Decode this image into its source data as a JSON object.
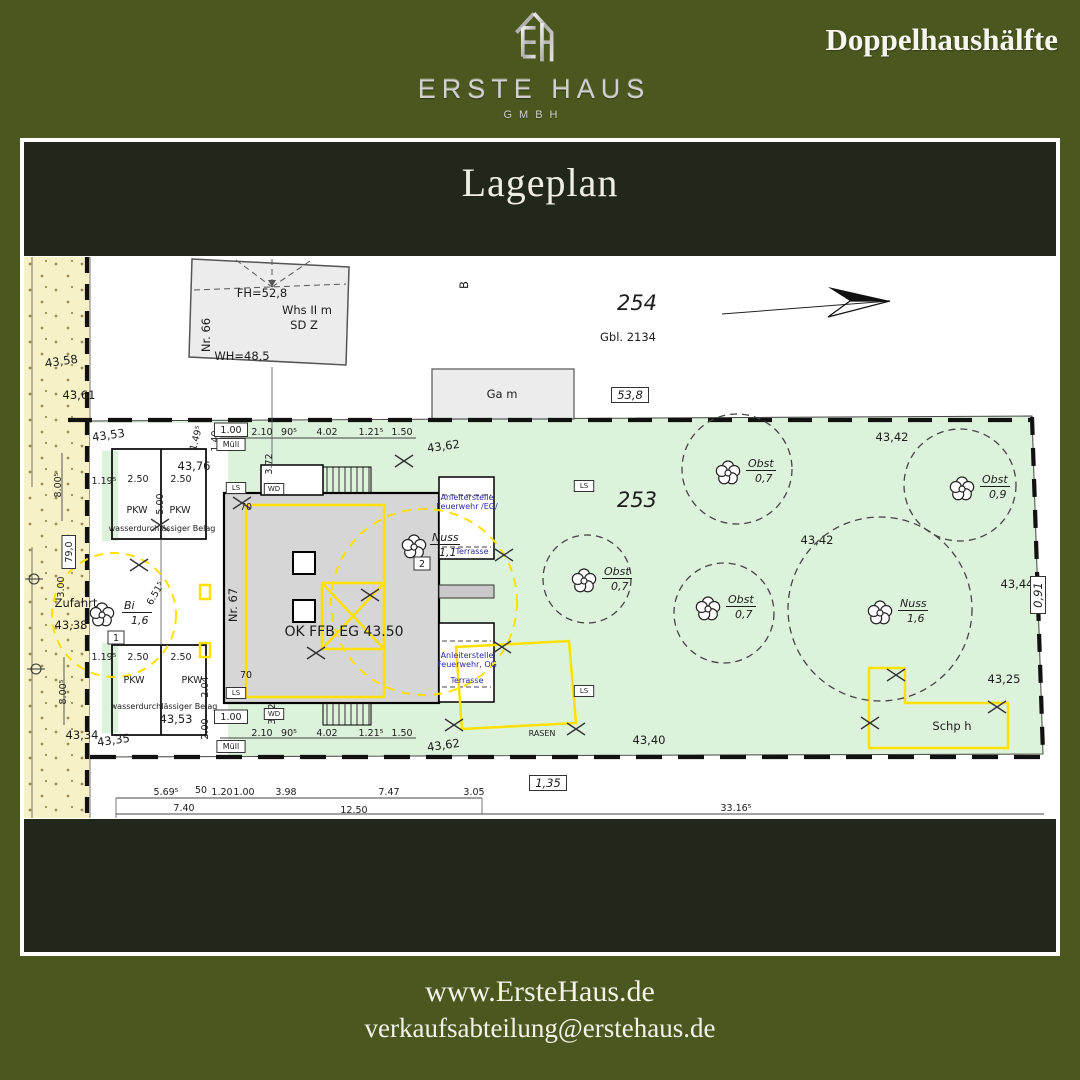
{
  "header": {
    "brand": "ERSTE HAUS",
    "brand_sub": "GMBH",
    "tagline": "Doppelhaushälfte"
  },
  "card": {
    "title": "Lageplan"
  },
  "footer": {
    "website": "www.ErsteHaus.de",
    "email": "verkaufsabteilung@erstehaus.de"
  },
  "colors": {
    "page_bg": "#4a581f",
    "band_bg": "#22271c",
    "card_bg": "#ffffff",
    "parcel_green": "#ddf2db",
    "street_yellow": "#f6f1c6",
    "accent_yellow": "#ffe000",
    "note_blue": "#2b2b9e",
    "building_gray": "#d6d6d6",
    "neighbor_gray": "#ececec",
    "text_light": "#f3f2e9",
    "logo_silver": "#d0d0d0"
  },
  "plan": {
    "parcels": [
      {
        "number": "254",
        "register": "Gbl. 2134"
      },
      {
        "number": "253"
      }
    ],
    "labels": [
      {
        "t": "FH=52,8",
        "x": 238,
        "y": 40,
        "n": "ridge-height-label"
      },
      {
        "t": "Nr. 66",
        "x": 186,
        "y": 78,
        "r": -90,
        "n": "house-number-66"
      },
      {
        "t": "Whs II m",
        "x": 283,
        "y": 57
      },
      {
        "t": "SD Z",
        "x": 280,
        "y": 72
      },
      {
        "t": "WH=48,5",
        "x": 218,
        "y": 103
      },
      {
        "t": "B",
        "x": 444,
        "y": 28,
        "r": -90
      },
      {
        "t": "254",
        "x": 613,
        "y": 53,
        "s": "lg",
        "n": "parcel-number-254"
      },
      {
        "t": "Gbl. 2134",
        "x": 604,
        "y": 84
      },
      {
        "t": "Ga m",
        "x": 478,
        "y": 141,
        "n": "garage-label"
      },
      {
        "t": "53,8",
        "x": 606,
        "y": 142,
        "s": "it",
        "box": true
      },
      {
        "t": "43,58",
        "x": 38,
        "y": 108,
        "r": -8
      },
      {
        "t": "43,61",
        "x": 55,
        "y": 142
      },
      {
        "t": "43,53",
        "x": 85,
        "y": 182,
        "r": -8
      },
      {
        "t": "Zufahrt",
        "x": 52,
        "y": 350,
        "n": "driveway-label"
      },
      {
        "t": "43,38",
        "x": 47,
        "y": 372
      },
      {
        "t": "43,34",
        "x": 58,
        "y": 482
      },
      {
        "t": "79,0",
        "x": 48,
        "y": 295,
        "r": -90,
        "s": "sm",
        "box": true
      },
      {
        "t": "3.00",
        "x": 40,
        "y": 330,
        "r": -90,
        "s": "sm"
      },
      {
        "t": "8.00⁵",
        "x": 37,
        "y": 228,
        "r": -90,
        "s": "sm"
      },
      {
        "t": "8.00⁵",
        "x": 42,
        "y": 435,
        "r": -90,
        "s": "sm"
      },
      {
        "t": "43,76",
        "x": 170,
        "y": 213
      },
      {
        "t": "2.50",
        "x": 114,
        "y": 225,
        "s": "sm"
      },
      {
        "t": "2.50",
        "x": 157,
        "y": 225,
        "s": "sm"
      },
      {
        "t": "1.19⁵",
        "x": 80,
        "y": 227,
        "s": "sm"
      },
      {
        "t": "5.00",
        "x": 139,
        "y": 247,
        "r": -90,
        "s": "sm"
      },
      {
        "t": "PKW",
        "x": 113,
        "y": 256,
        "s": "sm",
        "n": "parking-space-label"
      },
      {
        "t": "PKW",
        "x": 156,
        "y": 256,
        "s": "sm",
        "n": "parking-space-label"
      },
      {
        "t": "wasserdurchlässiger Belag",
        "x": 138,
        "y": 274,
        "s": "xs"
      },
      {
        "t": "1.19⁵",
        "x": 80,
        "y": 403,
        "s": "sm"
      },
      {
        "t": "2.50",
        "x": 114,
        "y": 403,
        "s": "sm"
      },
      {
        "t": "2.50",
        "x": 157,
        "y": 403,
        "s": "sm"
      },
      {
        "t": "PKW",
        "x": 110,
        "y": 426,
        "s": "sm",
        "n": "parking-space-label"
      },
      {
        "t": "PKW",
        "x": 168,
        "y": 426,
        "s": "sm",
        "n": "parking-space-label"
      },
      {
        "t": "wasserdurchlässiger Belag",
        "x": 140,
        "y": 452,
        "s": "xs"
      },
      {
        "t": "43,53",
        "x": 152,
        "y": 466
      },
      {
        "t": "43,35",
        "x": 90,
        "y": 487,
        "r": -8
      },
      {
        "t": "1.49⁵",
        "x": 175,
        "y": 182,
        "r": -75,
        "s": "sm"
      },
      {
        "t": "1.40",
        "x": 194,
        "y": 184,
        "r": -90,
        "s": "sm"
      },
      {
        "t": "1.00",
        "x": 207,
        "y": 176,
        "s": "sm",
        "box": true
      },
      {
        "t": "Müll",
        "x": 207,
        "y": 190,
        "s": "xs",
        "box": true
      },
      {
        "t": "2.10",
        "x": 238,
        "y": 178,
        "s": "sm"
      },
      {
        "t": "90⁵",
        "x": 265,
        "y": 178,
        "s": "sm"
      },
      {
        "t": "4.02",
        "x": 303,
        "y": 178,
        "s": "sm"
      },
      {
        "t": "1.21⁵",
        "x": 347,
        "y": 178,
        "s": "sm"
      },
      {
        "t": "1.50",
        "x": 378,
        "y": 178,
        "s": "sm"
      },
      {
        "t": "43,62",
        "x": 420,
        "y": 193,
        "r": -8
      },
      {
        "t": "3.72",
        "x": 248,
        "y": 207,
        "r": -90,
        "s": "sm"
      },
      {
        "t": "70",
        "x": 222,
        "y": 253,
        "s": "sm"
      },
      {
        "t": "Nr. 67",
        "x": 213,
        "y": 348,
        "r": -90,
        "n": "house-number-67"
      },
      {
        "t": "6.51⁵",
        "x": 134,
        "y": 338,
        "r": -60,
        "s": "sm"
      },
      {
        "t": "OK FFB EG 43.50",
        "x": 320,
        "y": 379,
        "s": "md2",
        "n": "floor-level-label"
      },
      {
        "t": "70",
        "x": 222,
        "y": 421,
        "s": "sm"
      },
      {
        "t": "2.04",
        "x": 184,
        "y": 430,
        "r": -90,
        "s": "sm"
      },
      {
        "t": "2.00",
        "x": 184,
        "y": 472,
        "r": -90,
        "s": "sm"
      },
      {
        "t": "1.00",
        "x": 207,
        "y": 463,
        "s": "sm",
        "box": true
      },
      {
        "t": "Müll",
        "x": 207,
        "y": 492,
        "s": "xs",
        "box": true
      },
      {
        "t": "2.10",
        "x": 238,
        "y": 479,
        "s": "sm"
      },
      {
        "t": "90⁵",
        "x": 265,
        "y": 479,
        "s": "sm"
      },
      {
        "t": "4.02",
        "x": 303,
        "y": 479,
        "s": "sm"
      },
      {
        "t": "1.21⁵",
        "x": 347,
        "y": 479,
        "s": "sm"
      },
      {
        "t": "1.50",
        "x": 378,
        "y": 479,
        "s": "sm"
      },
      {
        "t": "43,62",
        "x": 420,
        "y": 492,
        "r": -8
      },
      {
        "t": "3.72",
        "x": 251,
        "y": 457,
        "r": -90,
        "s": "sm"
      },
      {
        "t": "LS",
        "x": 212,
        "y": 233,
        "s": "ls",
        "box": true
      },
      {
        "t": "WD",
        "x": 250,
        "y": 234,
        "s": "ls",
        "box": true
      },
      {
        "t": "LS",
        "x": 560,
        "y": 231,
        "s": "ls",
        "box": true
      },
      {
        "t": "LS",
        "x": 212,
        "y": 438,
        "s": "ls",
        "box": true
      },
      {
        "t": "WD",
        "x": 250,
        "y": 459,
        "s": "ls",
        "box": true
      },
      {
        "t": "LS",
        "x": 560,
        "y": 436,
        "s": "ls",
        "box": true
      },
      {
        "t": "Anleiterstelle",
        "x": 443,
        "y": 243,
        "s": "xsb"
      },
      {
        "t": "Feuerwehr /EG/",
        "x": 443,
        "y": 252,
        "s": "xsb"
      },
      {
        "t": "Terrasse",
        "x": 448,
        "y": 297,
        "s": "xsb"
      },
      {
        "t": "Anleiterstelle",
        "x": 443,
        "y": 401,
        "s": "xsb"
      },
      {
        "t": "Feuerwehr, OG",
        "x": 443,
        "y": 410,
        "s": "xsb"
      },
      {
        "t": "Terrasse",
        "x": 443,
        "y": 426,
        "s": "xsb"
      },
      {
        "t": "253",
        "x": 613,
        "y": 250,
        "s": "lg",
        "n": "parcel-number-253"
      },
      {
        "t": "43,42",
        "x": 868,
        "y": 184
      },
      {
        "t": "43,42",
        "x": 793,
        "y": 287
      },
      {
        "t": "43,44",
        "x": 993,
        "y": 331
      },
      {
        "t": "43,25",
        "x": 980,
        "y": 426
      },
      {
        "t": "43,40",
        "x": 625,
        "y": 487
      },
      {
        "t": "RASEN",
        "x": 518,
        "y": 479,
        "s": "xs",
        "n": "lawn-label"
      },
      {
        "t": "Schp h",
        "x": 928,
        "y": 473,
        "n": "shed-label"
      },
      {
        "t": "0,91",
        "x": 1018,
        "y": 338,
        "r": -90,
        "s": "it",
        "box": true
      },
      {
        "t": "1,35",
        "x": 524,
        "y": 530,
        "s": "it",
        "box": true
      },
      {
        "t": "5.69⁵",
        "x": 142,
        "y": 538,
        "s": "sm"
      },
      {
        "t": "50",
        "x": 177,
        "y": 536,
        "s": "sm"
      },
      {
        "t": "1.20",
        "x": 198,
        "y": 538,
        "s": "sm"
      },
      {
        "t": "1.00",
        "x": 220,
        "y": 538,
        "s": "sm"
      },
      {
        "t": "3.98",
        "x": 262,
        "y": 538,
        "s": "sm"
      },
      {
        "t": "7.47",
        "x": 365,
        "y": 538,
        "s": "sm"
      },
      {
        "t": "3.05",
        "x": 450,
        "y": 538,
        "s": "sm"
      },
      {
        "t": "7.40",
        "x": 160,
        "y": 554,
        "s": "sm"
      },
      {
        "t": "12.50",
        "x": 330,
        "y": 556,
        "s": "sm"
      },
      {
        "t": "33.16⁵",
        "x": 712,
        "y": 554,
        "s": "sm"
      }
    ],
    "trees": [
      {
        "species": "Bi",
        "size": "1,6",
        "fx": 78,
        "fy": 358,
        "lx": 100,
        "ly": 352,
        "badge": "1",
        "bx": 92,
        "by": 384
      },
      {
        "species": "Nuss",
        "size": "1,1",
        "fx": 390,
        "fy": 290,
        "lx": 408,
        "ly": 284,
        "badge": "2",
        "bx": 398,
        "by": 310
      },
      {
        "species": "Obst",
        "size": "0,7",
        "fx": 560,
        "fy": 324,
        "lx": 580,
        "ly": 318,
        "circle": [
          563,
          322,
          44
        ]
      },
      {
        "species": "Obst",
        "size": "0,7",
        "fx": 704,
        "fy": 216,
        "lx": 724,
        "ly": 210,
        "circle": [
          713,
          212,
          55
        ]
      },
      {
        "species": "Obst",
        "size": "0,9",
        "fx": 938,
        "fy": 232,
        "lx": 958,
        "ly": 226,
        "circle": [
          936,
          228,
          56
        ]
      },
      {
        "species": "Obst",
        "size": "0,7",
        "fx": 684,
        "fy": 352,
        "lx": 704,
        "ly": 346,
        "circle": [
          700,
          356,
          50
        ]
      },
      {
        "species": "Nuss",
        "size": "1,6",
        "fx": 856,
        "fy": 356,
        "lx": 876,
        "ly": 350,
        "circle": [
          856,
          352,
          92
        ]
      }
    ],
    "x_marks": [
      [
        218,
        246
      ],
      [
        380,
        204
      ],
      [
        480,
        298
      ],
      [
        292,
        396
      ],
      [
        346,
        338
      ],
      [
        115,
        308
      ],
      [
        136,
        268
      ],
      [
        478,
        390
      ],
      [
        430,
        468
      ],
      [
        552,
        472
      ],
      [
        846,
        466
      ],
      [
        872,
        418
      ],
      [
        973,
        450
      ]
    ],
    "survey_points": [
      [
        10,
        322
      ],
      [
        12,
        412
      ]
    ]
  }
}
